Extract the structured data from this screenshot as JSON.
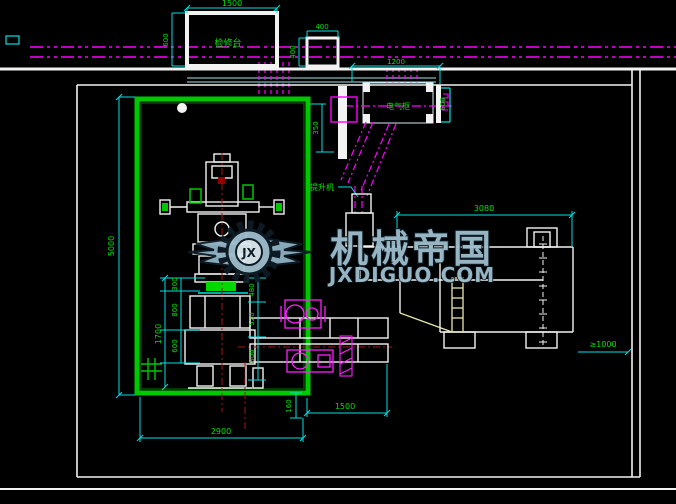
{
  "drawing": {
    "type": "factory-layout-cad-plan",
    "background": "#000000"
  },
  "colors": {
    "wall_white": "#F2F2F2",
    "room_green": "#00C800",
    "dim_line_cyan": "#00E0E0",
    "dim_text_green": "#00E100",
    "conveyor_magenta": "#FF00FF",
    "centerline_red": "#A51414",
    "ladder_yellow": "#E6E6B0",
    "watermark_fill": "#9FBECD",
    "watermark_outline": "#0E1C26"
  },
  "watermark": {
    "brand": "机械帝国",
    "site": "JXDIGUO.COM",
    "monogram": "JX"
  },
  "labels": {
    "platform": "检修台",
    "cabinet": "电气柜",
    "incline_conveyor": "提升机"
  },
  "dimensions": {
    "platform_width": "1500",
    "platform_depth": "600",
    "chute_width": "400",
    "chute_height": "400",
    "cabinet_width": "1200",
    "cabinet_side": "600",
    "wall_gap": "350",
    "room_height": "5000",
    "room_width": "2900",
    "press_height_total": "1700",
    "press_seg_a": "300",
    "press_seg_b": "800",
    "press_seg_c": "600",
    "center_a": "480",
    "center_b": "520",
    "center_c": "800",
    "outlet_gap": "160",
    "bench_run": "1500",
    "machine_length": "3080",
    "service_clearance": "≥1000"
  }
}
